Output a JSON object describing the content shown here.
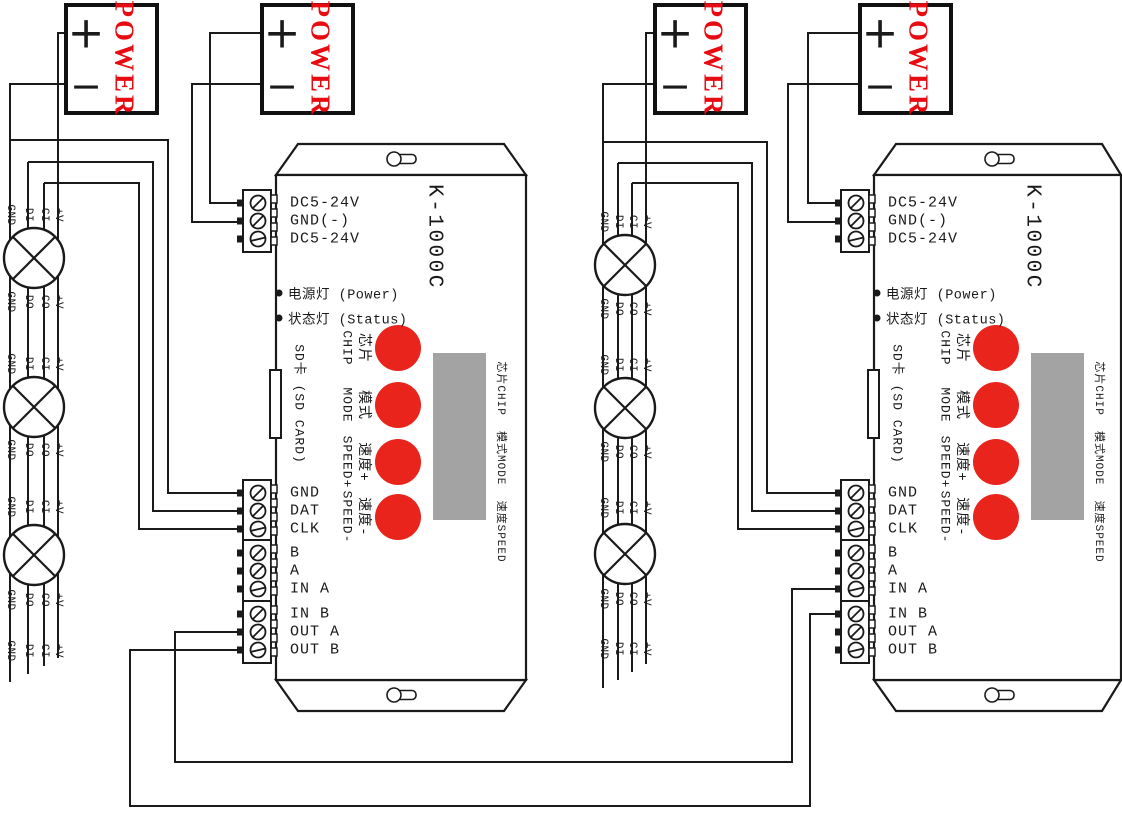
{
  "colors": {
    "wire": "#1a1a1a",
    "power_red": "#e60c12",
    "button_red": "#e8241d",
    "lcd_gray": "#a3a3a3"
  },
  "power_supply": {
    "label": "POWER",
    "plus": "+",
    "minus": "−"
  },
  "controller": {
    "model": "K-1000C",
    "dc_terminals": [
      "DC5-24V",
      "GND(-)",
      "DC5-24V"
    ],
    "indicators": [
      "电源灯 (Power)",
      "状态灯 (Status)"
    ],
    "sd_slot": "SD卡 (SD CARD)",
    "buttons": [
      {
        "cn": "芯片",
        "en": "CHIP"
      },
      {
        "cn": "模式",
        "en": "MODE"
      },
      {
        "cn": "速度+",
        "en": "SPEED+"
      },
      {
        "cn": "速度-",
        "en": "SPEED-"
      }
    ],
    "display_side_label": "芯片CHIP  模式MODE  速度SPEED",
    "signal_terminals": [
      "GND",
      "DAT",
      "CLK"
    ],
    "io_terminals_a": [
      "B",
      "A",
      "IN A"
    ],
    "io_terminals_b": [
      "IN B",
      "OUT A",
      "OUT B"
    ]
  },
  "led_module": {
    "input_pins": [
      "GND",
      "DI",
      "CI",
      "+V"
    ],
    "output_pins": [
      "GND",
      "DO",
      "CO",
      "+V"
    ]
  }
}
